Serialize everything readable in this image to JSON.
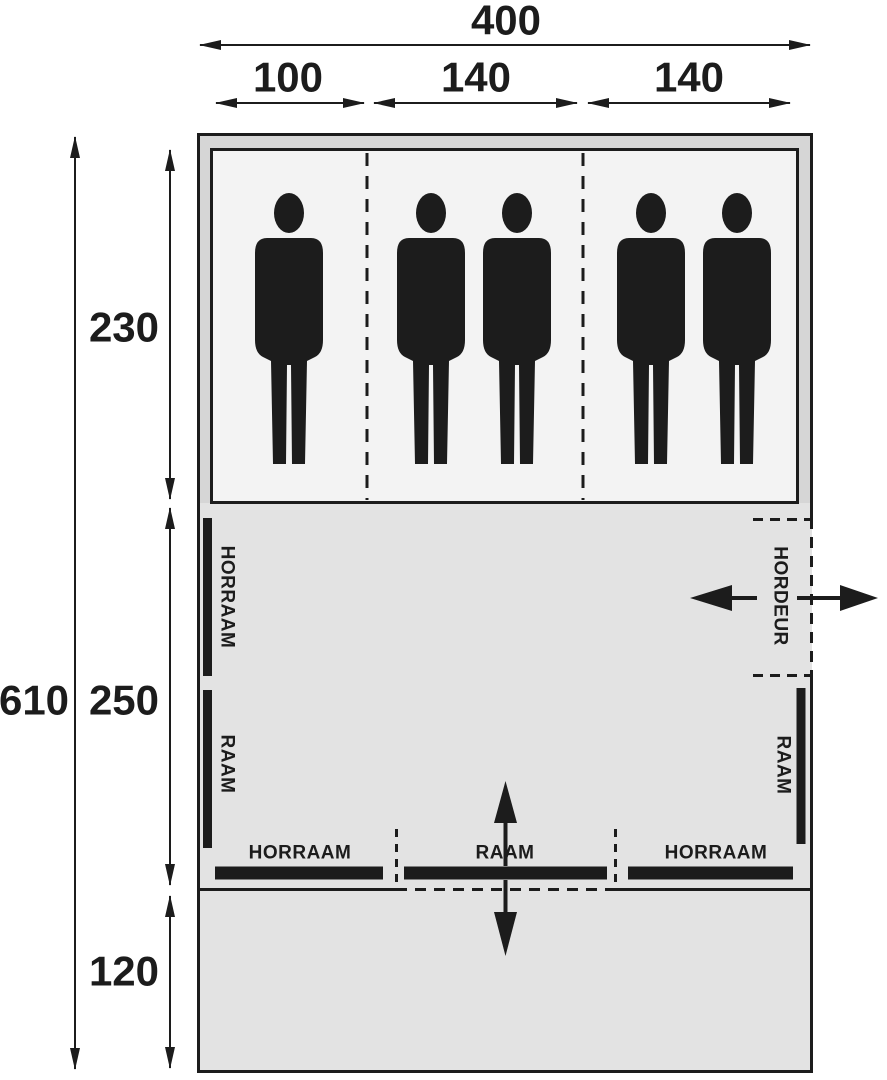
{
  "diagram": {
    "type": "tent-floorplan",
    "colors": {
      "line": "#1c1c1c",
      "tent_band_fill": "#d6d6d6",
      "room_fill": "#e3e3e3",
      "sleeping_area_fill": "#f3f3f3",
      "background": "#ffffff"
    },
    "dimensions": {
      "total_width": "400",
      "width_segments": [
        "100",
        "140",
        "140"
      ],
      "total_depth": "610",
      "depth_segments": [
        "230",
        "250",
        "120"
      ]
    },
    "labels": {
      "left_window_top": "HORRAAM",
      "left_window_bottom": "RAAM",
      "right_door": "HORDEUR",
      "right_window": "RAAM",
      "front_window_left": "HORRAAM",
      "front_window_center": "RAAM",
      "front_window_right": "HORRAAM"
    },
    "occupants": 5
  }
}
